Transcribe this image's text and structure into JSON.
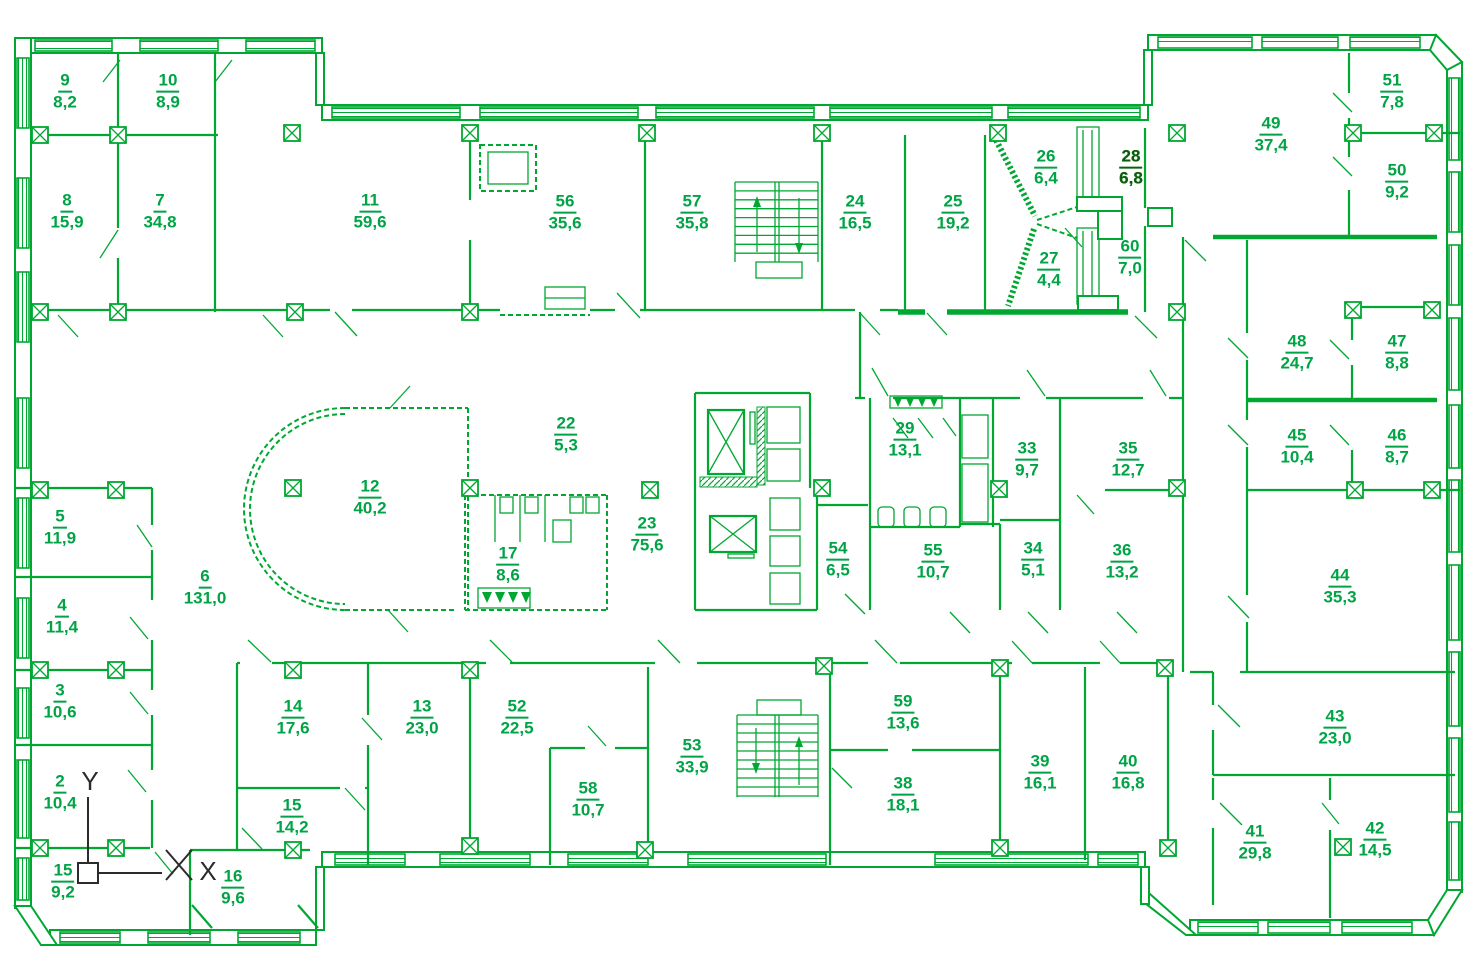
{
  "canvas": {
    "width": 1478,
    "height": 974,
    "background": "#ffffff"
  },
  "colors": {
    "line": "#00A832",
    "label": "#00A446",
    "label_emphasis": "#0A5F0A",
    "axis": "#2b2b2b"
  },
  "axis_marker": {
    "x_label": "X",
    "y_label": "Y"
  },
  "rooms": [
    {
      "number": "9",
      "area": "8,2",
      "x": 65,
      "y": 92
    },
    {
      "number": "10",
      "area": "8,9",
      "x": 168,
      "y": 92
    },
    {
      "number": "8",
      "area": "15,9",
      "x": 67,
      "y": 212
    },
    {
      "number": "7",
      "area": "34,8",
      "x": 160,
      "y": 212
    },
    {
      "number": "11",
      "area": "59,6",
      "x": 370,
      "y": 212
    },
    {
      "number": "56",
      "area": "35,6",
      "x": 565,
      "y": 213
    },
    {
      "number": "57",
      "area": "35,8",
      "x": 692,
      "y": 213
    },
    {
      "number": "24",
      "area": "16,5",
      "x": 855,
      "y": 213
    },
    {
      "number": "25",
      "area": "19,2",
      "x": 953,
      "y": 213
    },
    {
      "number": "26",
      "area": "6,4",
      "x": 1046,
      "y": 168
    },
    {
      "number": "28",
      "area": "6,8",
      "x": 1131,
      "y": 168,
      "bold": true
    },
    {
      "number": "27",
      "area": "4,4",
      "x": 1049,
      "y": 270
    },
    {
      "number": "60",
      "area": "7,0",
      "x": 1130,
      "y": 258
    },
    {
      "number": "49",
      "area": "37,4",
      "x": 1271,
      "y": 135
    },
    {
      "number": "51",
      "area": "7,8",
      "x": 1392,
      "y": 92
    },
    {
      "number": "50",
      "area": "9,2",
      "x": 1397,
      "y": 182
    },
    {
      "number": "48",
      "area": "24,7",
      "x": 1297,
      "y": 353
    },
    {
      "number": "47",
      "area": "8,8",
      "x": 1397,
      "y": 353
    },
    {
      "number": "45",
      "area": "10,4",
      "x": 1297,
      "y": 447
    },
    {
      "number": "46",
      "area": "8,7",
      "x": 1397,
      "y": 447
    },
    {
      "number": "44",
      "area": "35,3",
      "x": 1340,
      "y": 587
    },
    {
      "number": "5",
      "area": "11,9",
      "x": 60,
      "y": 528
    },
    {
      "number": "4",
      "area": "11,4",
      "x": 62,
      "y": 617
    },
    {
      "number": "6",
      "area": "131,0",
      "x": 205,
      "y": 588
    },
    {
      "number": "12",
      "area": "40,2",
      "x": 370,
      "y": 498
    },
    {
      "number": "22",
      "area": "5,3",
      "x": 566,
      "y": 435
    },
    {
      "number": "17",
      "area": "8,6",
      "x": 508,
      "y": 565
    },
    {
      "number": "23",
      "area": "75,6",
      "x": 647,
      "y": 535
    },
    {
      "number": "54",
      "area": "6,5",
      "x": 838,
      "y": 560
    },
    {
      "number": "29",
      "area": "13,1",
      "x": 905,
      "y": 440
    },
    {
      "number": "33",
      "area": "9,7",
      "x": 1027,
      "y": 460
    },
    {
      "number": "35",
      "area": "12,7",
      "x": 1128,
      "y": 460
    },
    {
      "number": "55",
      "area": "10,7",
      "x": 933,
      "y": 562
    },
    {
      "number": "34",
      "area": "5,1",
      "x": 1033,
      "y": 560
    },
    {
      "number": "36",
      "area": "13,2",
      "x": 1122,
      "y": 562
    },
    {
      "number": "3",
      "area": "10,6",
      "x": 60,
      "y": 702
    },
    {
      "number": "2",
      "area": "10,4",
      "x": 60,
      "y": 793
    },
    {
      "number": "15",
      "area": "9,2",
      "x": 63,
      "y": 882
    },
    {
      "number": "16",
      "area": "9,6",
      "x": 233,
      "y": 888
    },
    {
      "number": "14",
      "area": "17,6",
      "x": 293,
      "y": 718
    },
    {
      "number": "15",
      "area": "14,2",
      "x": 292,
      "y": 817
    },
    {
      "number": "13",
      "area": "23,0",
      "x": 422,
      "y": 718
    },
    {
      "number": "52",
      "area": "22,5",
      "x": 517,
      "y": 718
    },
    {
      "number": "58",
      "area": "10,7",
      "x": 588,
      "y": 800
    },
    {
      "number": "53",
      "area": "33,9",
      "x": 692,
      "y": 757
    },
    {
      "number": "59",
      "area": "13,6",
      "x": 903,
      "y": 713
    },
    {
      "number": "38",
      "area": "18,1",
      "x": 903,
      "y": 795
    },
    {
      "number": "39",
      "area": "16,1",
      "x": 1040,
      "y": 773
    },
    {
      "number": "40",
      "area": "16,8",
      "x": 1128,
      "y": 773
    },
    {
      "number": "43",
      "area": "23,0",
      "x": 1335,
      "y": 728
    },
    {
      "number": "41",
      "area": "29,8",
      "x": 1255,
      "y": 843
    },
    {
      "number": "42",
      "area": "14,5",
      "x": 1375,
      "y": 840
    }
  ]
}
